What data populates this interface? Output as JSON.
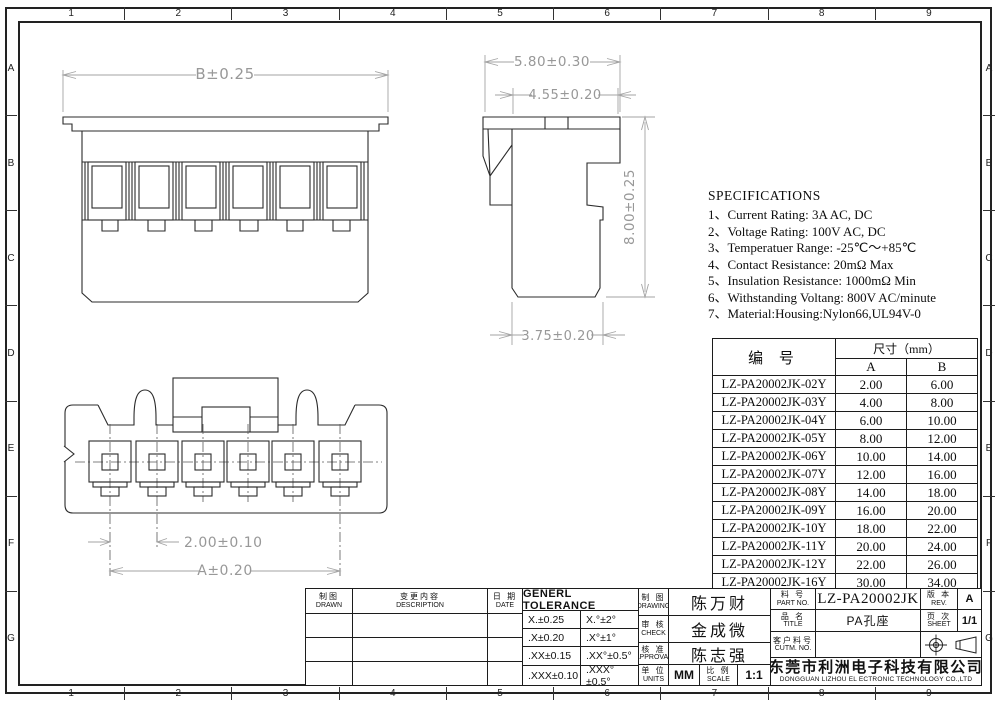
{
  "ruler": {
    "cols": [
      "1",
      "2",
      "3",
      "4",
      "5",
      "6",
      "7",
      "8",
      "9"
    ],
    "rows": [
      "A",
      "B",
      "C",
      "D",
      "E",
      "F",
      "G"
    ]
  },
  "dimensions": {
    "front_width": "B±0.25",
    "side_width_outer": "5.80±0.30",
    "side_width_inner": "4.55±0.20",
    "side_height": "8.00±0.25",
    "side_bottom": "3.75±0.20",
    "pin_pitch": "2.00±0.10",
    "pin_span": "A±0.20"
  },
  "specifications": {
    "title": "SPECIFICATIONS",
    "lines": [
      "1、Current Rating: 3A AC, DC",
      "2、Voltage Rating: 100V AC, DC",
      "3、Temperatuer Range: -25℃～+85℃",
      "4、Contact Resistance: 20mΩ Max",
      "5、Insulation Resistance: 1000mΩ Min",
      "6、Withstanding Voltang: 800V AC/minute",
      "7、Material:Housing:Nylon66,UL94V-0"
    ]
  },
  "size_table": {
    "col_part": "编  号",
    "col_size": "尺寸（mm）",
    "col_a": "A",
    "col_b": "B",
    "rows": [
      {
        "part": "LZ-PA20002JK-02Y",
        "a": "2.00",
        "b": "6.00"
      },
      {
        "part": "LZ-PA20002JK-03Y",
        "a": "4.00",
        "b": "8.00"
      },
      {
        "part": "LZ-PA20002JK-04Y",
        "a": "6.00",
        "b": "10.00"
      },
      {
        "part": "LZ-PA20002JK-05Y",
        "a": "8.00",
        "b": "12.00"
      },
      {
        "part": "LZ-PA20002JK-06Y",
        "a": "10.00",
        "b": "14.00"
      },
      {
        "part": "LZ-PA20002JK-07Y",
        "a": "12.00",
        "b": "16.00"
      },
      {
        "part": "LZ-PA20002JK-08Y",
        "a": "14.00",
        "b": "18.00"
      },
      {
        "part": "LZ-PA20002JK-09Y",
        "a": "16.00",
        "b": "20.00"
      },
      {
        "part": "LZ-PA20002JK-10Y",
        "a": "18.00",
        "b": "22.00"
      },
      {
        "part": "LZ-PA20002JK-11Y",
        "a": "20.00",
        "b": "24.00"
      },
      {
        "part": "LZ-PA20002JK-12Y",
        "a": "22.00",
        "b": "26.00"
      },
      {
        "part": "LZ-PA20002JK-16Y",
        "a": "30.00",
        "b": "34.00"
      }
    ]
  },
  "title_block": {
    "drawn": {
      "cn": "制图",
      "en": "DRAWN"
    },
    "description": {
      "cn": "变更内容",
      "en": "DESCRIPTION"
    },
    "date": {
      "cn": "日 期",
      "en": "DATE"
    },
    "tolerance": {
      "title": "GENERL  TOLERANCE",
      "rows": [
        {
          "lin": "X.±0.25",
          "ang": "X.°±2°"
        },
        {
          "lin": ".X±0.20",
          "ang": ".X°±1°"
        },
        {
          "lin": ".XX±0.15",
          "ang": ".XX°±0.5°"
        },
        {
          "lin": ".XXX±0.10",
          "ang": ".XXX°±0.5°"
        }
      ]
    },
    "drawing": {
      "cn": "制 图",
      "en": "DRAWING",
      "value": "陈万财"
    },
    "check": {
      "cn": "审 核",
      "en": "CHECK",
      "value": "金成微"
    },
    "approval": {
      "cn": "核 准",
      "en": "APPROVAL",
      "value": "陈志强"
    },
    "units": {
      "cn": "单 位",
      "en": "UNITS",
      "value": "MM"
    },
    "scale": {
      "cn": "比 例",
      "en": "SCALE",
      "value": "1:1"
    },
    "part_no": {
      "cn": "料 号",
      "en": "PART NO.",
      "value": "LZ-PA20002JK"
    },
    "product": {
      "cn": "品 名",
      "en": "TITLE",
      "value": "PA孔座"
    },
    "customer": {
      "cn": "客户料号",
      "en": "CUTM. NO.",
      "value": ""
    },
    "rev": {
      "cn": "版 本",
      "en": "REV.",
      "value": "A"
    },
    "sheet": {
      "cn": "页 次",
      "en": "SHEET",
      "value": "1/1"
    },
    "company": {
      "cn": "东莞市利洲电子科技有限公司",
      "en": "DONGGUAN LIZHOU EL ECTRONIC TECHNOLOGY CO.,LTD"
    }
  },
  "colors": {
    "line": "#2b2b2b",
    "dim_line": "#a3a3a3",
    "dim_text": "#989898",
    "bg": "#ffffff"
  }
}
